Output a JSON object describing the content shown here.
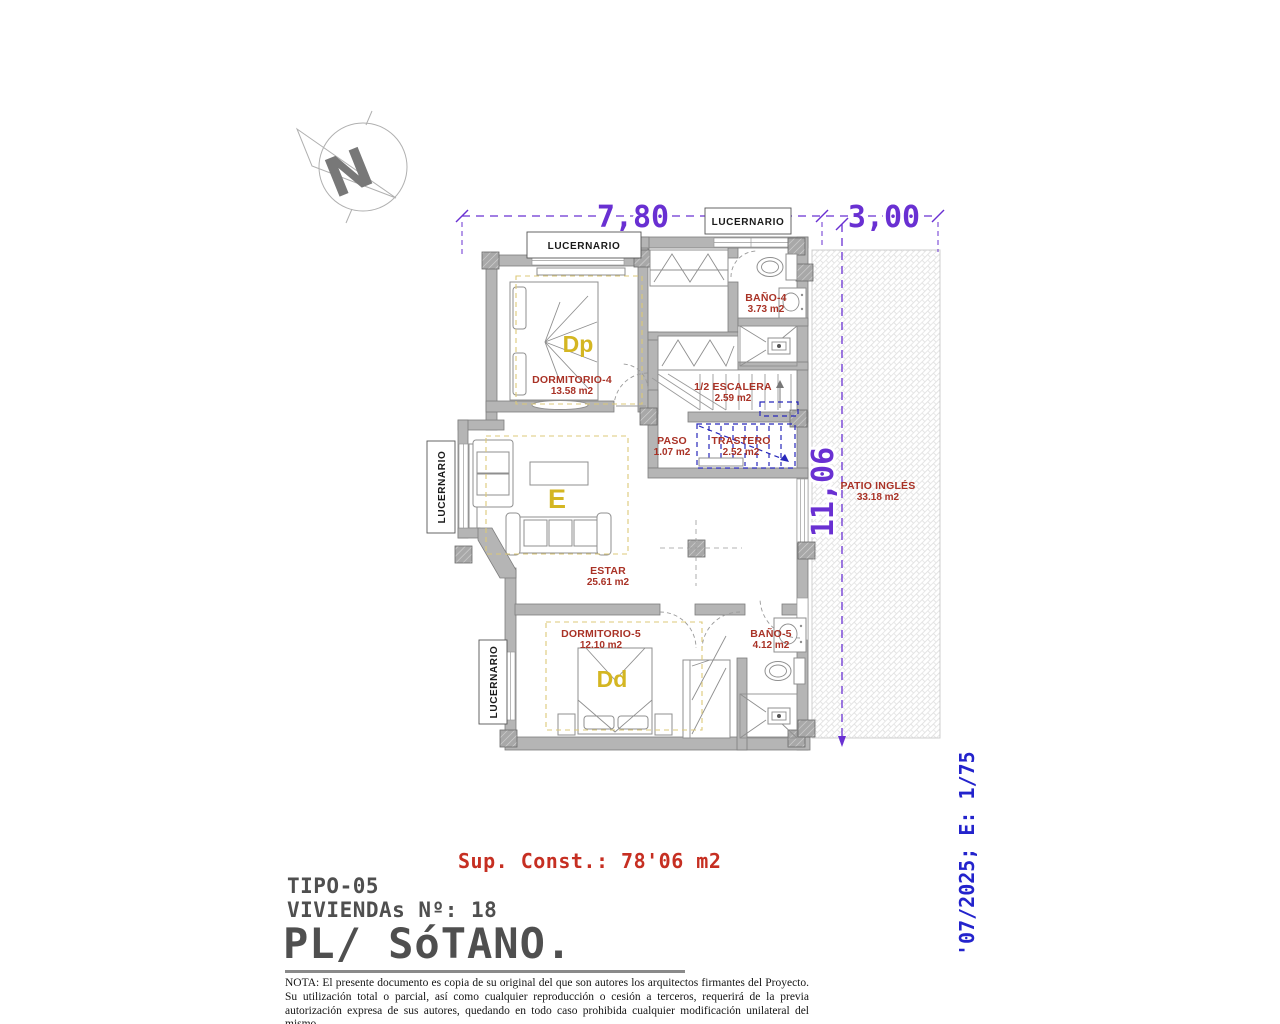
{
  "dimensions": {
    "width_main": "7,80",
    "width_patio": "3,00",
    "height": "11,06"
  },
  "skylight_label": "LUCERNARIO",
  "north": {
    "letter": "N"
  },
  "rooms": {
    "dormitorio4": {
      "name": "DORMITORIO-4",
      "area": "13.58 m2",
      "letter": "Dp"
    },
    "bano4": {
      "name": "BAÑO-4",
      "area": "3.73 m2"
    },
    "escalera": {
      "name": "1/2 ESCALERA",
      "area": "2.59 m2"
    },
    "paso": {
      "name": "PASO",
      "area": "1.07 m2"
    },
    "trastero": {
      "name": "TRASTERO",
      "area": "2.52 m2"
    },
    "estar": {
      "name": "ESTAR",
      "area": "25.61 m2",
      "letter": "E"
    },
    "dormitorio5": {
      "name": "DORMITORIO-5",
      "area": "12.10 m2",
      "letter": "Dd"
    },
    "bano5": {
      "name": "BAÑO-5",
      "area": "4.12 m2"
    },
    "patio": {
      "name": "PATIO INGLÉS",
      "area": "33.18 m2"
    }
  },
  "summary": {
    "sup_const": "Sup. Const.: 78'06 m2"
  },
  "title_block": {
    "tipo": "TIPO-05",
    "viviendas": "VIVIENDAs Nº: 18",
    "planta": "PL/ SóTANO."
  },
  "note": "NOTA: El presente documento es copia de su original del que son autores los arquitectos firmantes del Proyecto. Su utilización total o parcial, así como cualquier reproducción o cesión a terceros, requerirá  de la previa autorización expresa de sus autores, quedando en todo caso prohibida cualquier modificación unilateral del mismo.",
  "side_text": "'07/2025; E: 1/75",
  "colors": {
    "dimension_purple": "#6930d2",
    "room_label_red": "#a93226",
    "room_letter_yellow": "#d4b622",
    "summary_red": "#c62f22",
    "side_blue": "#2323cc",
    "trastero_blue": "#2727bb",
    "wall_gray": "#b5b5b5",
    "title_gray": "#4f4f4f"
  }
}
